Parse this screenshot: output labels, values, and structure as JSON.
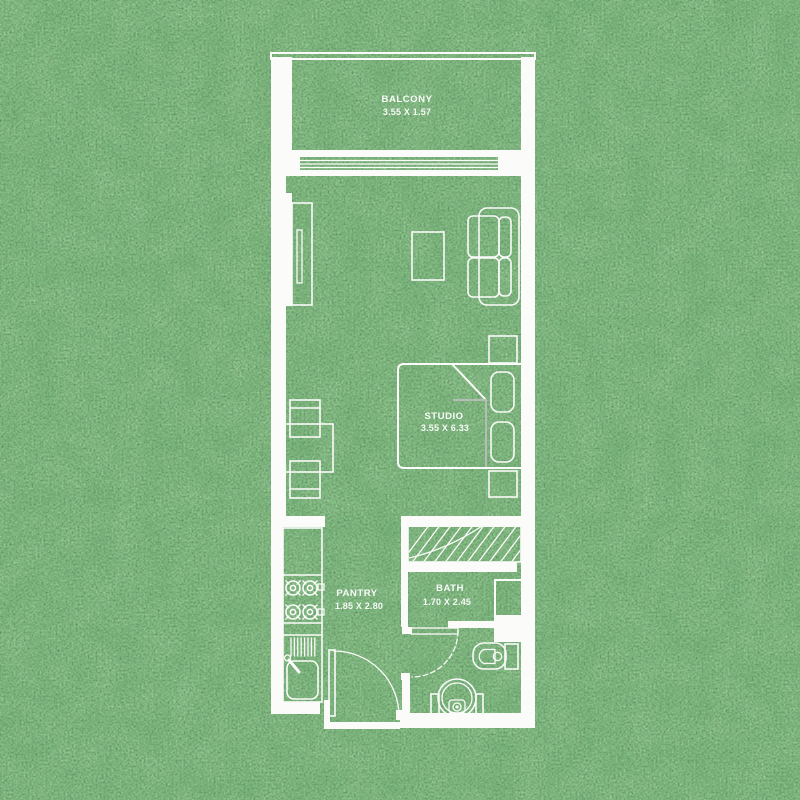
{
  "plan": {
    "type": "floor-plan",
    "rooms": [
      {
        "name": "BALCONY",
        "dimensions": "3.55 X 1.57"
      },
      {
        "name": "STUDIO",
        "dimensions": "3.55 X 6.33"
      },
      {
        "name": "PANTRY",
        "dimensions": "1.85 X 2.80"
      },
      {
        "name": "BATH",
        "dimensions": "1.70 X 2.45"
      }
    ]
  },
  "colors": {
    "wall": "#fbfbf9",
    "grass": "#3c7a3e",
    "soft_line": "#b6bdb4",
    "label_text": "#ffffff"
  }
}
